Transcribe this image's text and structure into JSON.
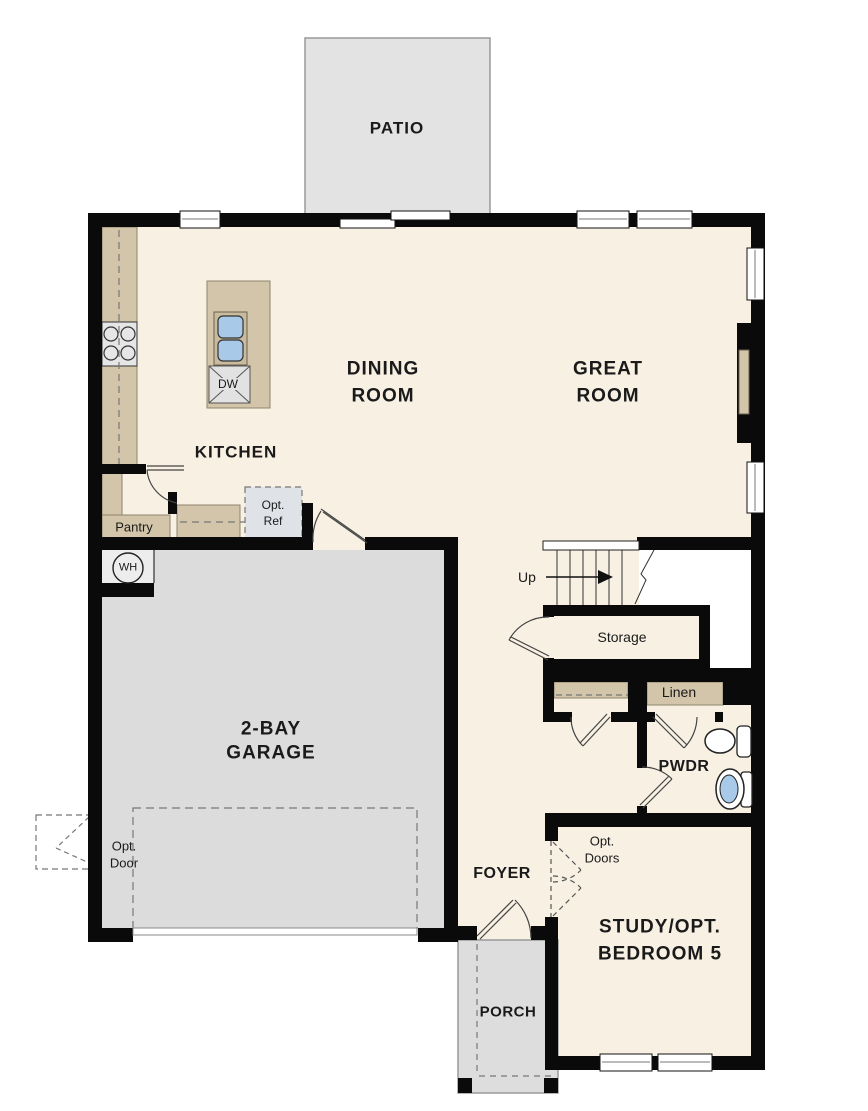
{
  "plan": {
    "type": "floor-plan",
    "rooms": {
      "patio": {
        "label": "PATIO"
      },
      "dining_room": {
        "line1": "DINING",
        "line2": "ROOM"
      },
      "great_room": {
        "line1": "GREAT",
        "line2": "ROOM"
      },
      "kitchen": {
        "label": "KITCHEN"
      },
      "garage": {
        "line1": "2-BAY",
        "line2": "GARAGE"
      },
      "foyer": {
        "label": "FOYER"
      },
      "study": {
        "line1": "STUDY/OPT.",
        "line2": "BEDROOM 5"
      },
      "porch": {
        "label": "PORCH"
      },
      "powder": {
        "label": "PWDR"
      },
      "storage": {
        "label": "Storage"
      },
      "pantry": {
        "label": "Pantry"
      },
      "linen": {
        "label": "Linen"
      }
    },
    "features": {
      "stairs": {
        "label": "Up"
      },
      "water_heater": {
        "label": "WH"
      },
      "dishwasher": {
        "label": "DW"
      },
      "opt_ref": {
        "line1": "Opt.",
        "line2": "Ref"
      },
      "opt_door": {
        "line1": "Opt.",
        "line2": "Door"
      },
      "opt_doors": {
        "line1": "Opt.",
        "line2": "Doors"
      }
    },
    "colors": {
      "floor": "#f7f0e3",
      "wall": "#0a0a0a",
      "counter": "#d2c5a9",
      "garage_floor": "#dcdcdc",
      "patio_floor": "#e3e3e3",
      "porch_floor": "#dddddd",
      "fixture_blue": "#a9c9e8",
      "white": "#ffffff"
    }
  }
}
